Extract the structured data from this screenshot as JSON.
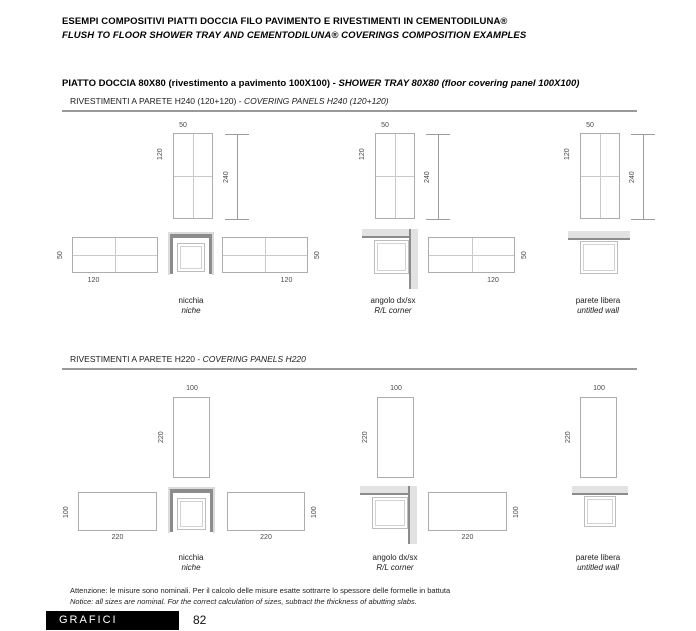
{
  "header": {
    "line1": "ESEMPI COMPOSITIVI PIATTI DOCCIA FILO PAVIMENTO E RIVESTIMENTI IN CEMENTODILUNA®",
    "line2": "FLUSH TO FLOOR SHOWER TRAY AND CEMENTODILUNA® COVERINGS COMPOSITION EXAMPLES"
  },
  "section_title": {
    "bold": "PIATTO DOCCIA  80X80  (rivestimento a pavimento 100X100) - ",
    "italic": "SHOWER TRAY 80X80 (floor covering panel 100X100)"
  },
  "h240": {
    "subtitle_plain": "RIVESTIMENTI A PARETE H240 (120+120) - ",
    "subtitle_italic": "COVERING PANELS H240 (120+120)",
    "dims": {
      "panel_width": "50",
      "panel_height": "120",
      "total_height": "240",
      "plan_length": "120",
      "plan_depth": "50"
    },
    "diagrams": [
      {
        "label_it": "nicchia",
        "label_en": "niche"
      },
      {
        "label_it": "angolo dx/sx",
        "label_en": "R/L corner"
      },
      {
        "label_it": "parete libera",
        "label_en": "untitled wall"
      }
    ]
  },
  "h220": {
    "subtitle_plain": "RIVESTIMENTI A PARETE H220 - ",
    "subtitle_italic": "COVERING PANELS H220",
    "dims": {
      "panel_width": "100",
      "panel_height": "220",
      "plan_length": "220",
      "plan_depth": "100"
    },
    "diagrams": [
      {
        "label_it": "nicchia",
        "label_en": "niche"
      },
      {
        "label_it": "angolo dx/sx",
        "label_en": "R/L corner"
      },
      {
        "label_it": "parete libera",
        "label_en": "untitled wall"
      }
    ]
  },
  "footnote": {
    "it": "Attenzione: le misure sono nominali.  Per il calcolo delle misure esatte sottrarre lo spessore delle formelle in battuta",
    "en": "Notice: all sizes are nominal. For the correct calculation of sizes, subtract the thickness of abutting slabs."
  },
  "footer": {
    "section_label": "GRAFICI",
    "page_number": "82"
  },
  "colors": {
    "wall_dark": "#8c8c8c",
    "wall_light": "#dcdcdc",
    "outline_gray": "#adadad",
    "footer_bar": "#000000"
  }
}
